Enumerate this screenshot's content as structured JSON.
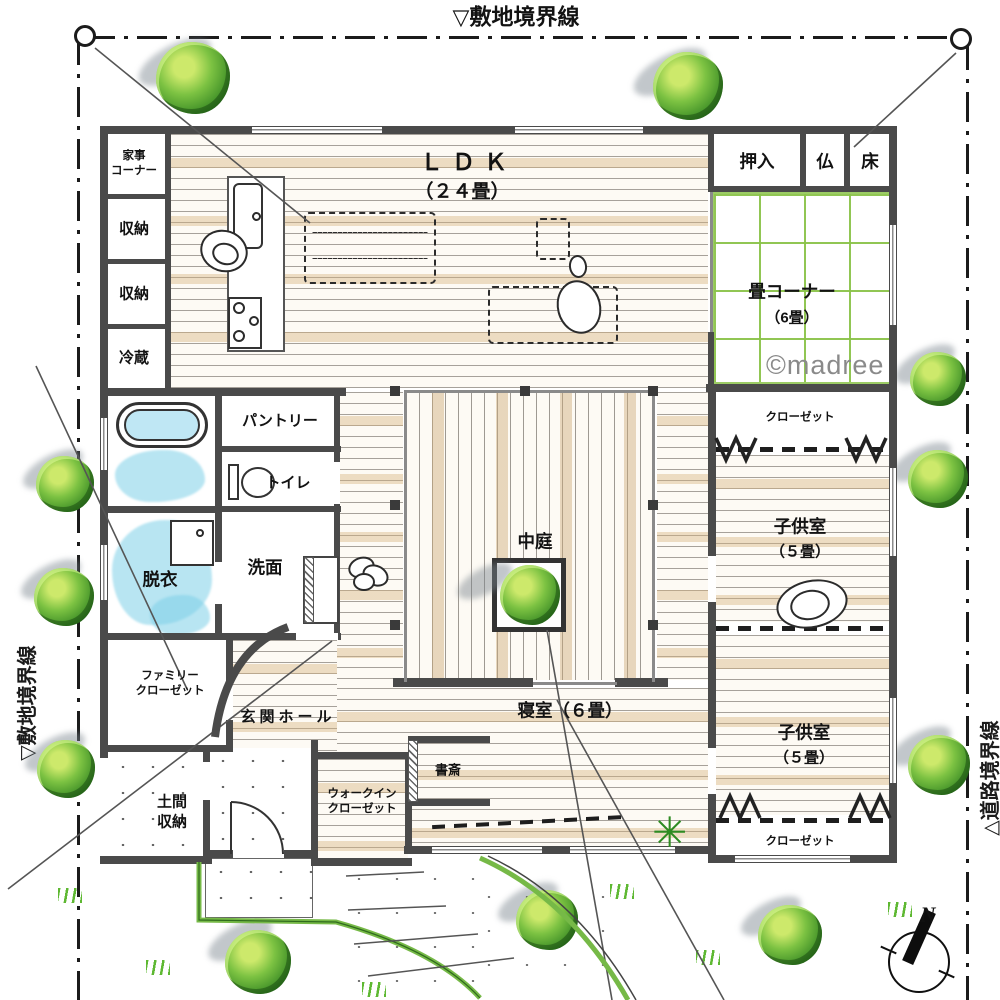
{
  "site": {
    "boundary_top": "▽敷地境界線",
    "boundary_left": "▽敷地境界線",
    "boundary_right": "△道路境界線"
  },
  "compass": {
    "north": "N"
  },
  "watermark": "©madree",
  "rooms": {
    "ldk_name": "ＬＤＫ",
    "ldk_size": "（２４畳）",
    "tatami_name": "畳コーナー",
    "tatami_size": "（6畳）",
    "oshiire": "押入",
    "butsudan": "仏",
    "tokonoma": "床",
    "kaji_corner": "家事\nコーナー",
    "storage_1": "収納",
    "storage_2": "収納",
    "fridge": "冷蔵",
    "pantry": "パントリー",
    "toilet": "トイレ",
    "dressing": "脱衣",
    "washroom": "洗面",
    "courtyard": "中庭",
    "closet_north": "クローゼット",
    "kids1_name": "子供室",
    "kids1_size": "（５畳）",
    "kids2_name": "子供室",
    "kids2_size": "（５畳）",
    "closet_south": "クローゼット",
    "bedroom": "寝室（６畳）",
    "study": "書斎",
    "walkin_closet": "ウォークイン\nクローゼット",
    "family_closet": "ファミリー\nクローゼット",
    "entrance_hall": "玄関ホール",
    "doma_storage": "土間\n収納"
  },
  "palette": {
    "wall": "#4a4a4a",
    "tatami_green": "#8bc34a",
    "tree_green": "#57a636",
    "water_blue": "#a8dff0",
    "curb_green": "#76b947",
    "wood_tan": "#e3c79d"
  }
}
